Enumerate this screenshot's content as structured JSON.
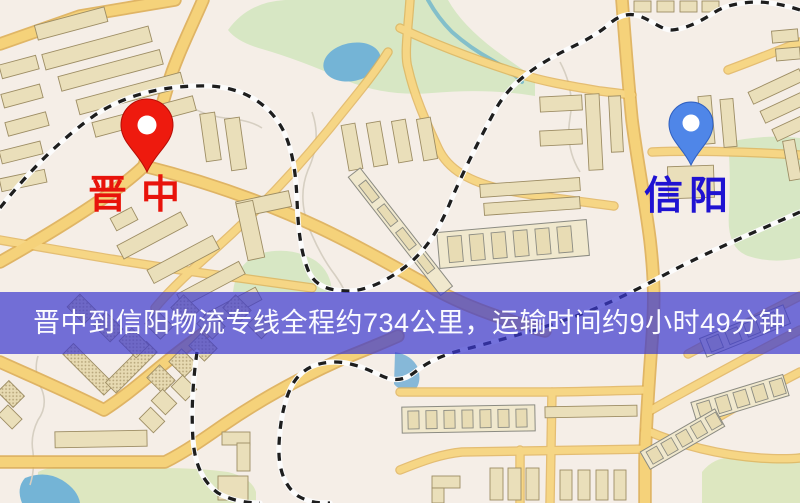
{
  "map": {
    "origin": {
      "name": "晋中",
      "pin_color": "#ee1a0e",
      "pin_stroke": "#b50d06",
      "label_color": "#e8130b"
    },
    "destination": {
      "name": "信阳",
      "pin_color": "#4f86e8",
      "pin_stroke": "#2f5fc0",
      "label_color": "#1f12d2"
    },
    "caption": {
      "text": "晋中到信阳物流专线全程约734公里，运输时间约9小时49分钟.",
      "distance_km": "734",
      "duration": "9小时49分钟",
      "band_color": "rgba(58,56,206,0.70)",
      "text_color": "#fbfbff"
    },
    "palette": {
      "background": "#f5eee7",
      "road_fill": "#f5d27a",
      "road_casing": "#dcab4f",
      "park": "#d7e7c4",
      "water": "#74b4d6",
      "building": "#eadfba",
      "railway_dash": "#1e1e1e"
    }
  }
}
